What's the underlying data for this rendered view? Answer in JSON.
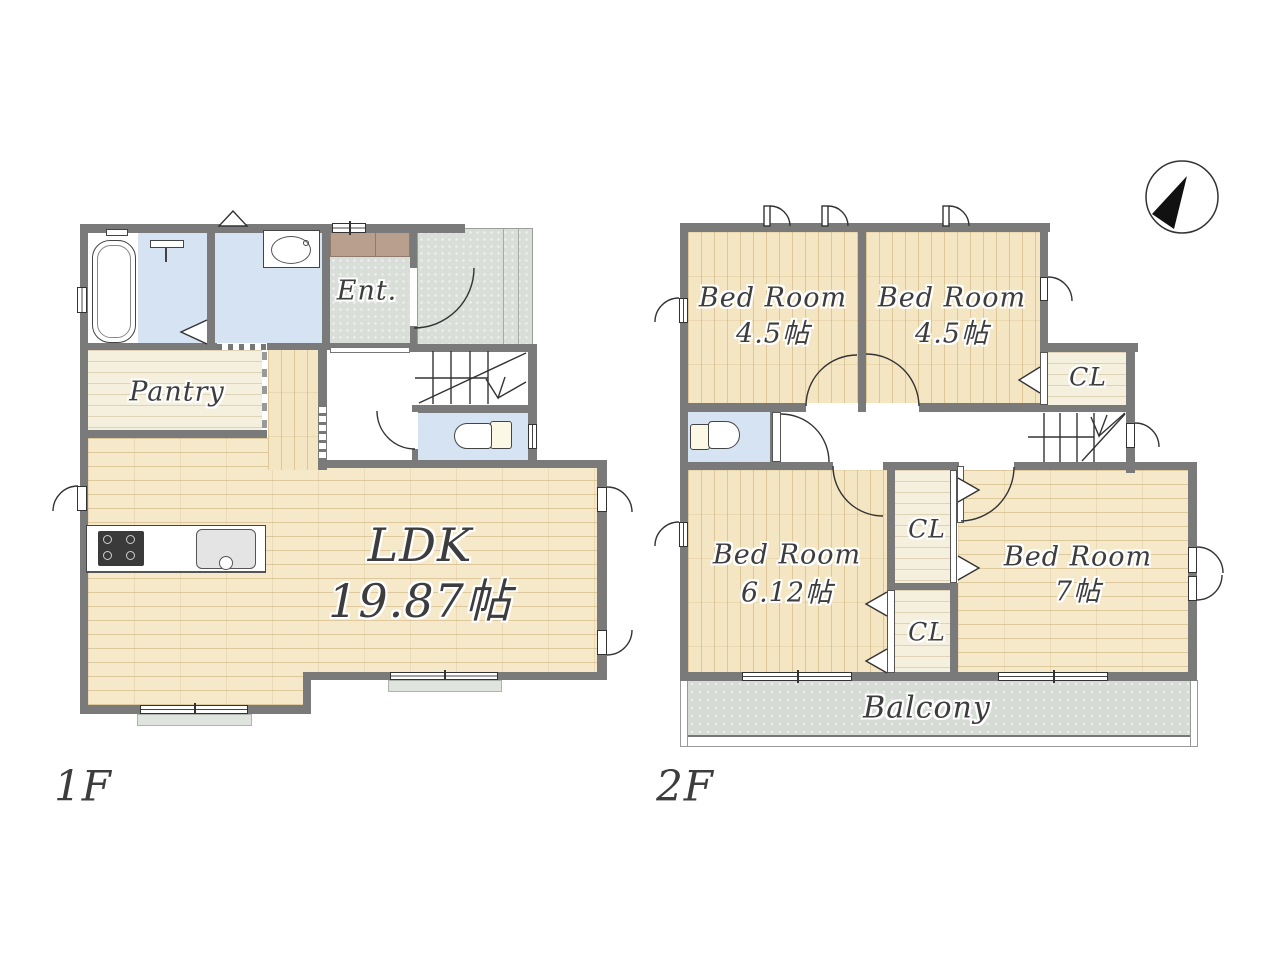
{
  "compass": {
    "north": "N"
  },
  "floor1": {
    "label": "1F",
    "rooms": {
      "entrance": "Ent.",
      "pantry": "Pantry",
      "ldk": {
        "name": "LDK",
        "area": "19.87帖"
      }
    }
  },
  "floor2": {
    "label": "2F",
    "rooms": {
      "bedroom_nw": {
        "name": "Bed Room",
        "area": "4.5帖"
      },
      "bedroom_ne": {
        "name": "Bed Room",
        "area": "4.5帖"
      },
      "bedroom_sw": {
        "name": "Bed Room",
        "area": "6.12帖"
      },
      "bedroom_se": {
        "name": "Bed Room",
        "area": "7帖"
      },
      "closet_north": "CL",
      "closet_mid_upper": "CL",
      "closet_mid_lower": "CL",
      "balcony": "Balcony"
    }
  },
  "colors": {
    "wall": "#7a7a7a",
    "wood_floor": "#f6e9c9",
    "water_rooms": "#d5e3f3",
    "entrance_floor": "#d9ded9",
    "balcony_floor": "#d6dbd5",
    "closet_floor": "#f5efde",
    "shoe_cabinet": "#b89f8e",
    "text": "#3d3d3d"
  }
}
